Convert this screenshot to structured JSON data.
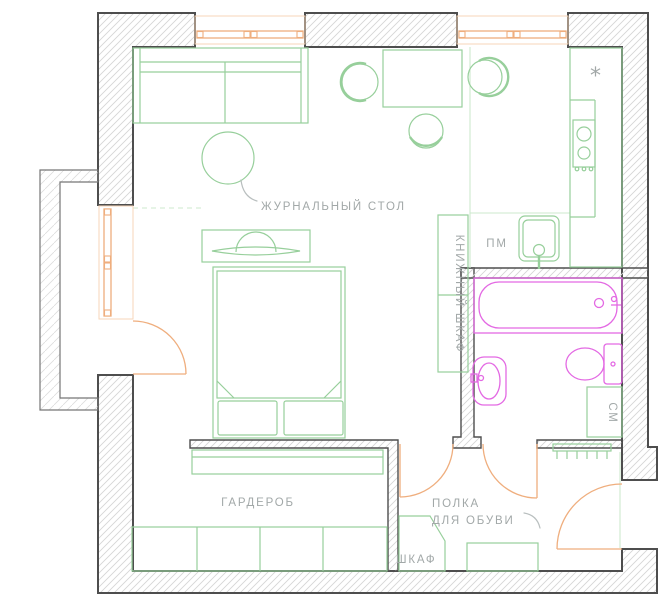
{
  "labels": {
    "coffee_table": "ЖУРНАЛЬНЫЙ СТОЛ",
    "dishwasher": "ПМ",
    "bookcase": "КНИЖНЫЙ ШКАФ",
    "washing_machine": "СМ",
    "wardrobe": "ГАРДЕРОБ",
    "shoe_shelf_line1": "ПОЛКА",
    "shoe_shelf_line2": "ДЛЯ ОБУВИ",
    "closet": "ШКАФ",
    "fridge_marker": "*"
  },
  "colors": {
    "wall": "#4e4e4e",
    "wall_lite": "#767676",
    "hatch": "#d6d6d6",
    "hatch_lite": "#dddddd",
    "furniture": "#97cf9b",
    "sanitary": "#e369e3",
    "joinery": "#efae7e",
    "joinery_lite": "#f7d6b8",
    "zone": "#cde9cd",
    "label": "#a2a8a8",
    "label_line": "#b9bfbf"
  }
}
